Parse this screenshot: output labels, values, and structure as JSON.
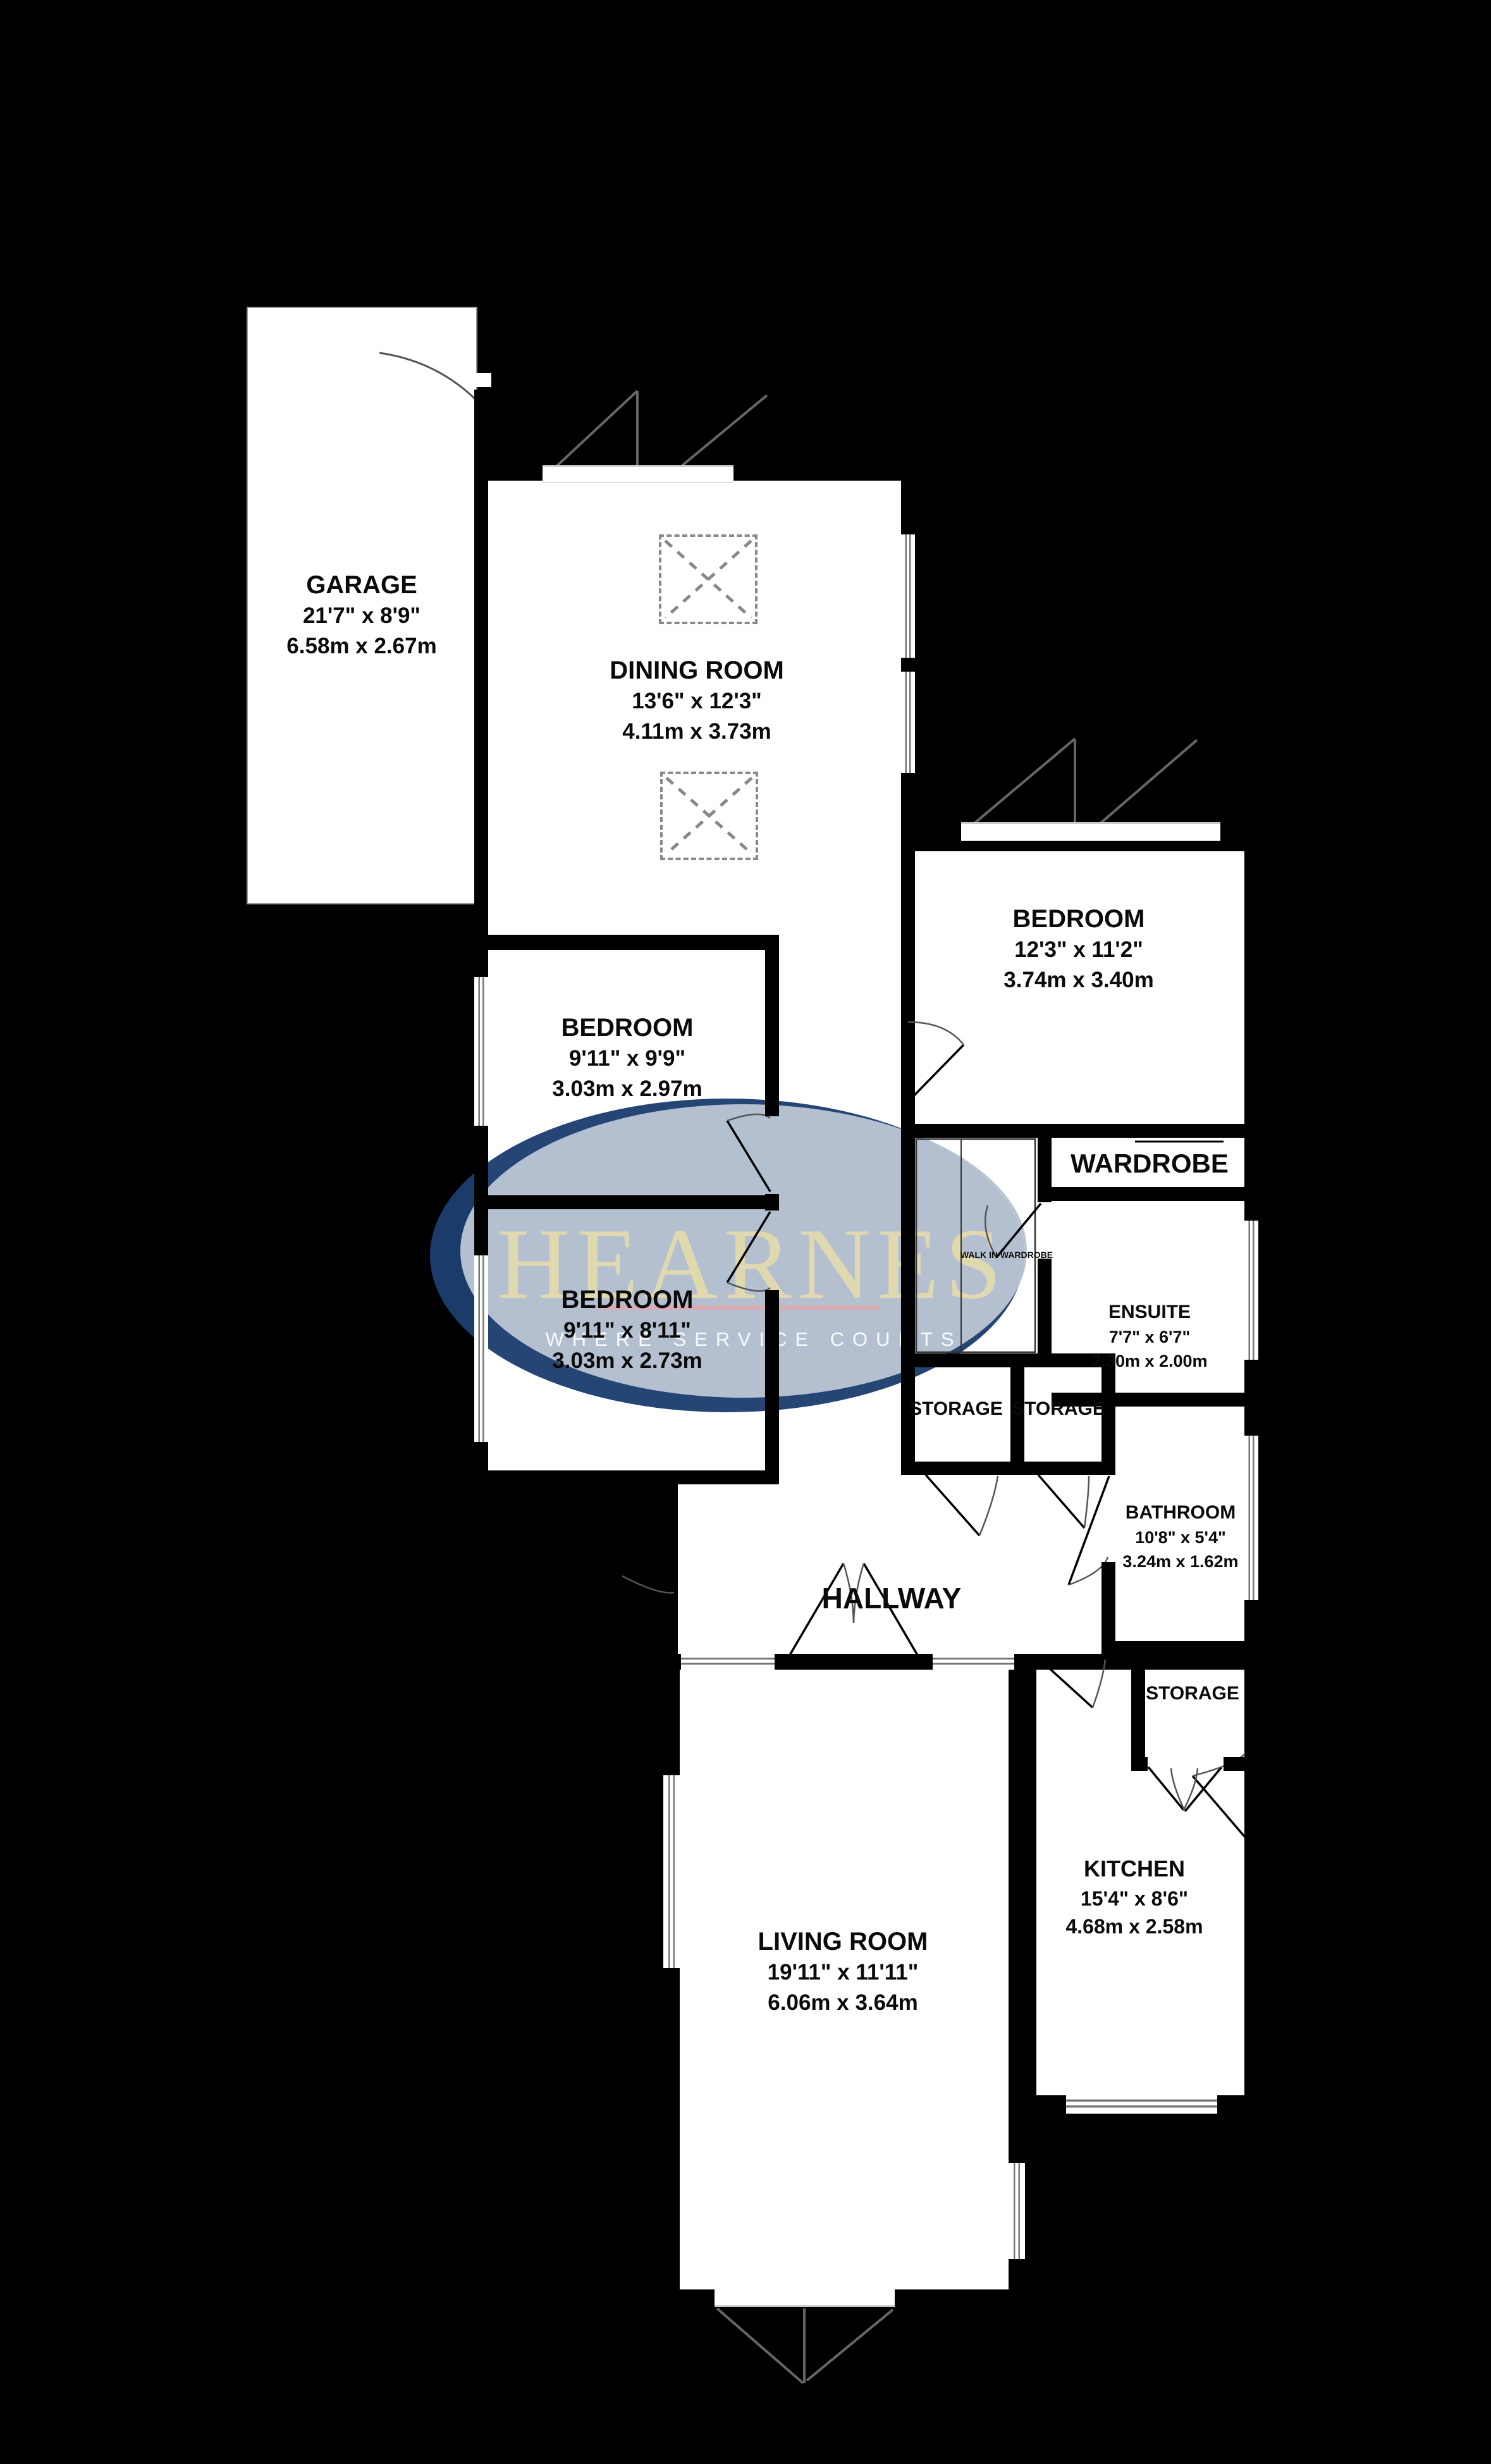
{
  "plan": {
    "title": "Bungalow floor plan",
    "colors": {
      "background": "#000000",
      "floor": "#ffffff",
      "wall": "#000000",
      "detail_line": "#555555",
      "logo_navy": "#1c3d6f",
      "logo_blue": "#b9c4d3",
      "logo_gold": "#ece0a8",
      "logo_pink": "#dfa8b2",
      "logo_tagline_color": "#ffffff"
    },
    "rooms": [
      {
        "name": "GARAGE",
        "imperial": "21'7\"  x 8'9\"",
        "metric": "6.58m  x 2.67m"
      },
      {
        "name": "DINING ROOM",
        "imperial": "13'6\"  x 12'3\"",
        "metric": "4.11m  x 3.73m"
      },
      {
        "name": "BEDROOM",
        "imperial": "12'3\"  x 11'2\"",
        "metric": "3.74m  x 3.40m"
      },
      {
        "name": "BEDROOM",
        "imperial": "9'11\"  x 9'9\"",
        "metric": "3.03m  x 2.97m"
      },
      {
        "name": "BEDROOM",
        "imperial": "9'11\"  x 8'11\"",
        "metric": "3.03m  x 2.73m"
      },
      {
        "name": "ENSUITE",
        "imperial": "7'7\"  x 6'7\"",
        "metric": "2.30m  x 2.00m"
      },
      {
        "name": "BATHROOM",
        "imperial": "10'8\"  x 5'4\"",
        "metric": "3.24m  x 1.62m"
      },
      {
        "name": "KITCHEN",
        "imperial": "15'4\"  x 8'6\"",
        "metric": "4.68m  x 2.58m"
      },
      {
        "name": "LIVING ROOM",
        "imperial": "19'11\"  x 11'11\"",
        "metric": "6.06m  x 3.64m"
      }
    ],
    "labels": {
      "hallway": "HALLWAY",
      "wardrobe": "WARDROBE",
      "storage": "STORAGE",
      "walk_in_wardrobe": "WALK IN WARDROBE"
    },
    "logo": {
      "name": "HEARNES",
      "tagline": "WHERE SERVICE COUNTS"
    }
  }
}
